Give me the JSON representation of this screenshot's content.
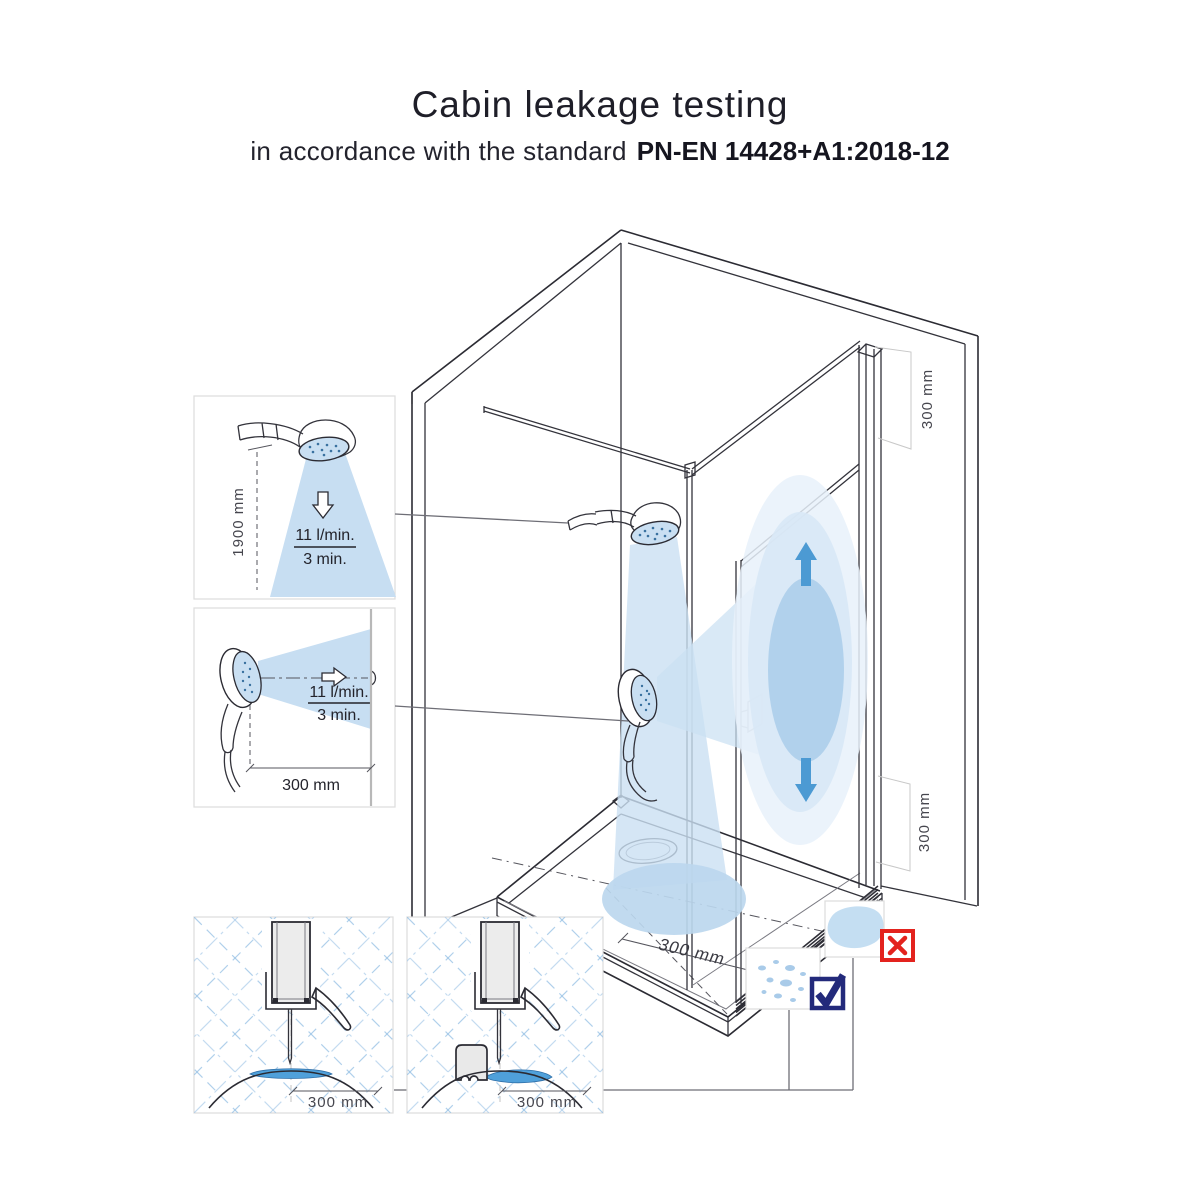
{
  "header": {
    "title": "Cabin leakage testing",
    "subtitle_prefix": "in accordance with the standard",
    "subtitle_standard": "PN-EN 14428+A1:2018-12"
  },
  "insets": {
    "vertical_spray": {
      "height_label": "1900 mm",
      "flow_rate": "11 l/min.",
      "duration": "3 min."
    },
    "horizontal_spray": {
      "distance_label": "300 mm",
      "flow_rate": "11 l/min.",
      "duration": "3 min."
    },
    "seal_plain": {
      "distance_label": "300 mm"
    },
    "seal_sponge": {
      "distance_label": "300 mm"
    }
  },
  "cabin": {
    "top_gap_label": "300 mm",
    "bottom_gap_label": "300 mm",
    "tray_spray_distance_label": "300 mm",
    "fail_icon": "x-mark-icon",
    "pass_icon": "checkmark-icon"
  },
  "colors": {
    "spray_light": "#cbe0f3",
    "spray_mid": "#b3d3ec",
    "spray_halo": "#e4eff9",
    "arrow_blue": "#4c9ad3",
    "water_blue": "#4fa0da",
    "fail_red": "#e3231e",
    "pass_navy": "#232a7b",
    "line": "#33333b"
  }
}
